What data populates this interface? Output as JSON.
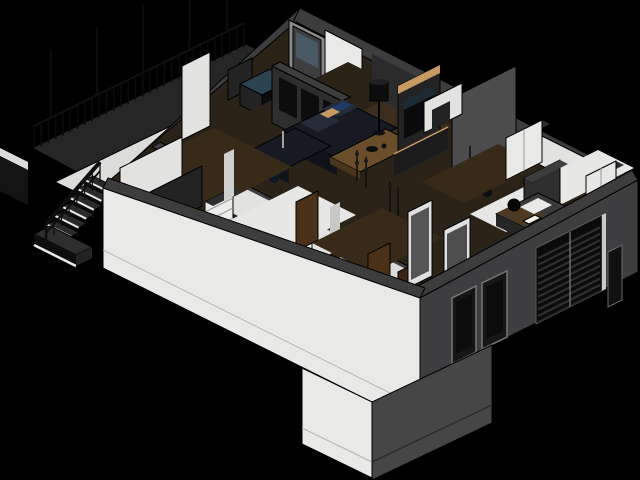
{
  "scene": {
    "title": "3D isometric cutaway render of a single-storey house floor plan",
    "view": "axonometric cutaway, black background",
    "elements": [
      "balcony-deck",
      "deck-railing",
      "railing-posts",
      "exterior-staircase",
      "stair-landing",
      "walkway",
      "white-sw-facade",
      "dark-se-facade",
      "entry-door-1",
      "entry-door-2",
      "louvered-window",
      "slit-window",
      "glazed-apex-door",
      "kitchen-counter",
      "glass-cooktop",
      "media-partition",
      "sectional-sofa",
      "throw-pillows",
      "coffee-table",
      "floor-lamp",
      "floor-candles",
      "floor-vases",
      "tv-media-wall",
      "media-console",
      "pendant-lights",
      "gray-wall-panel",
      "hallway",
      "interior-door-1",
      "interior-door-2",
      "entry-inner-door",
      "framed-gray-doors",
      "white-dresser",
      "shelving-unit",
      "dark-closet",
      "bedroom-bed",
      "bed-pillows",
      "bed-blanket",
      "bedside-lamp",
      "sphere-lamp",
      "headboard-wall",
      "wardrobe-1",
      "wardrobe-2",
      "entry-porch-block"
    ]
  },
  "details": {
    "deck_balusters": 30,
    "deck_posts": 5,
    "stair_steps": 7,
    "rail_balusters": 8,
    "louver_slats": 11,
    "hatch_lines": 10
  },
  "colors": {
    "bg": "#000000",
    "wall_top": "#3d3d3d",
    "wall_top_dark": "#2e2e2e",
    "facade_white": "#e9e9e7",
    "facade_white_dim": "#dcdcda",
    "facade_dark": "#3e3e40",
    "protrusion_dark": "#464646",
    "deck": "#262626",
    "void": "#141414",
    "floor_wood": "#2b2218",
    "floor_rug": "#3c2d1c",
    "floor_light": "#e7e7e5",
    "hall_wood": "#382a19",
    "wall_white": "#e2e2e0",
    "panel_dark": "#232323",
    "panel_mid": "#4c4c4c",
    "partition_face": "#2e2e2e",
    "furniture_black": "#0d0d0d",
    "sofa_dark": "#171a23",
    "sofa_front": "#10131a",
    "sofa_light": "#262b38",
    "wood_accent": "#c59a63",
    "table_wood": "#6a4e2c",
    "table_side": "#4a351d",
    "door_brown": "#4a3118",
    "door_dark_brown": "#3a2414",
    "glass_blue": "#2e4350",
    "vase_blue": "#102036",
    "pillow_blue": "#1e3a66",
    "bed_blanket": "#4e3a22",
    "lamp_glow": "#f5f0e2",
    "white_trim": "#eceff0",
    "gray_frame": "#8a8a8a"
  }
}
